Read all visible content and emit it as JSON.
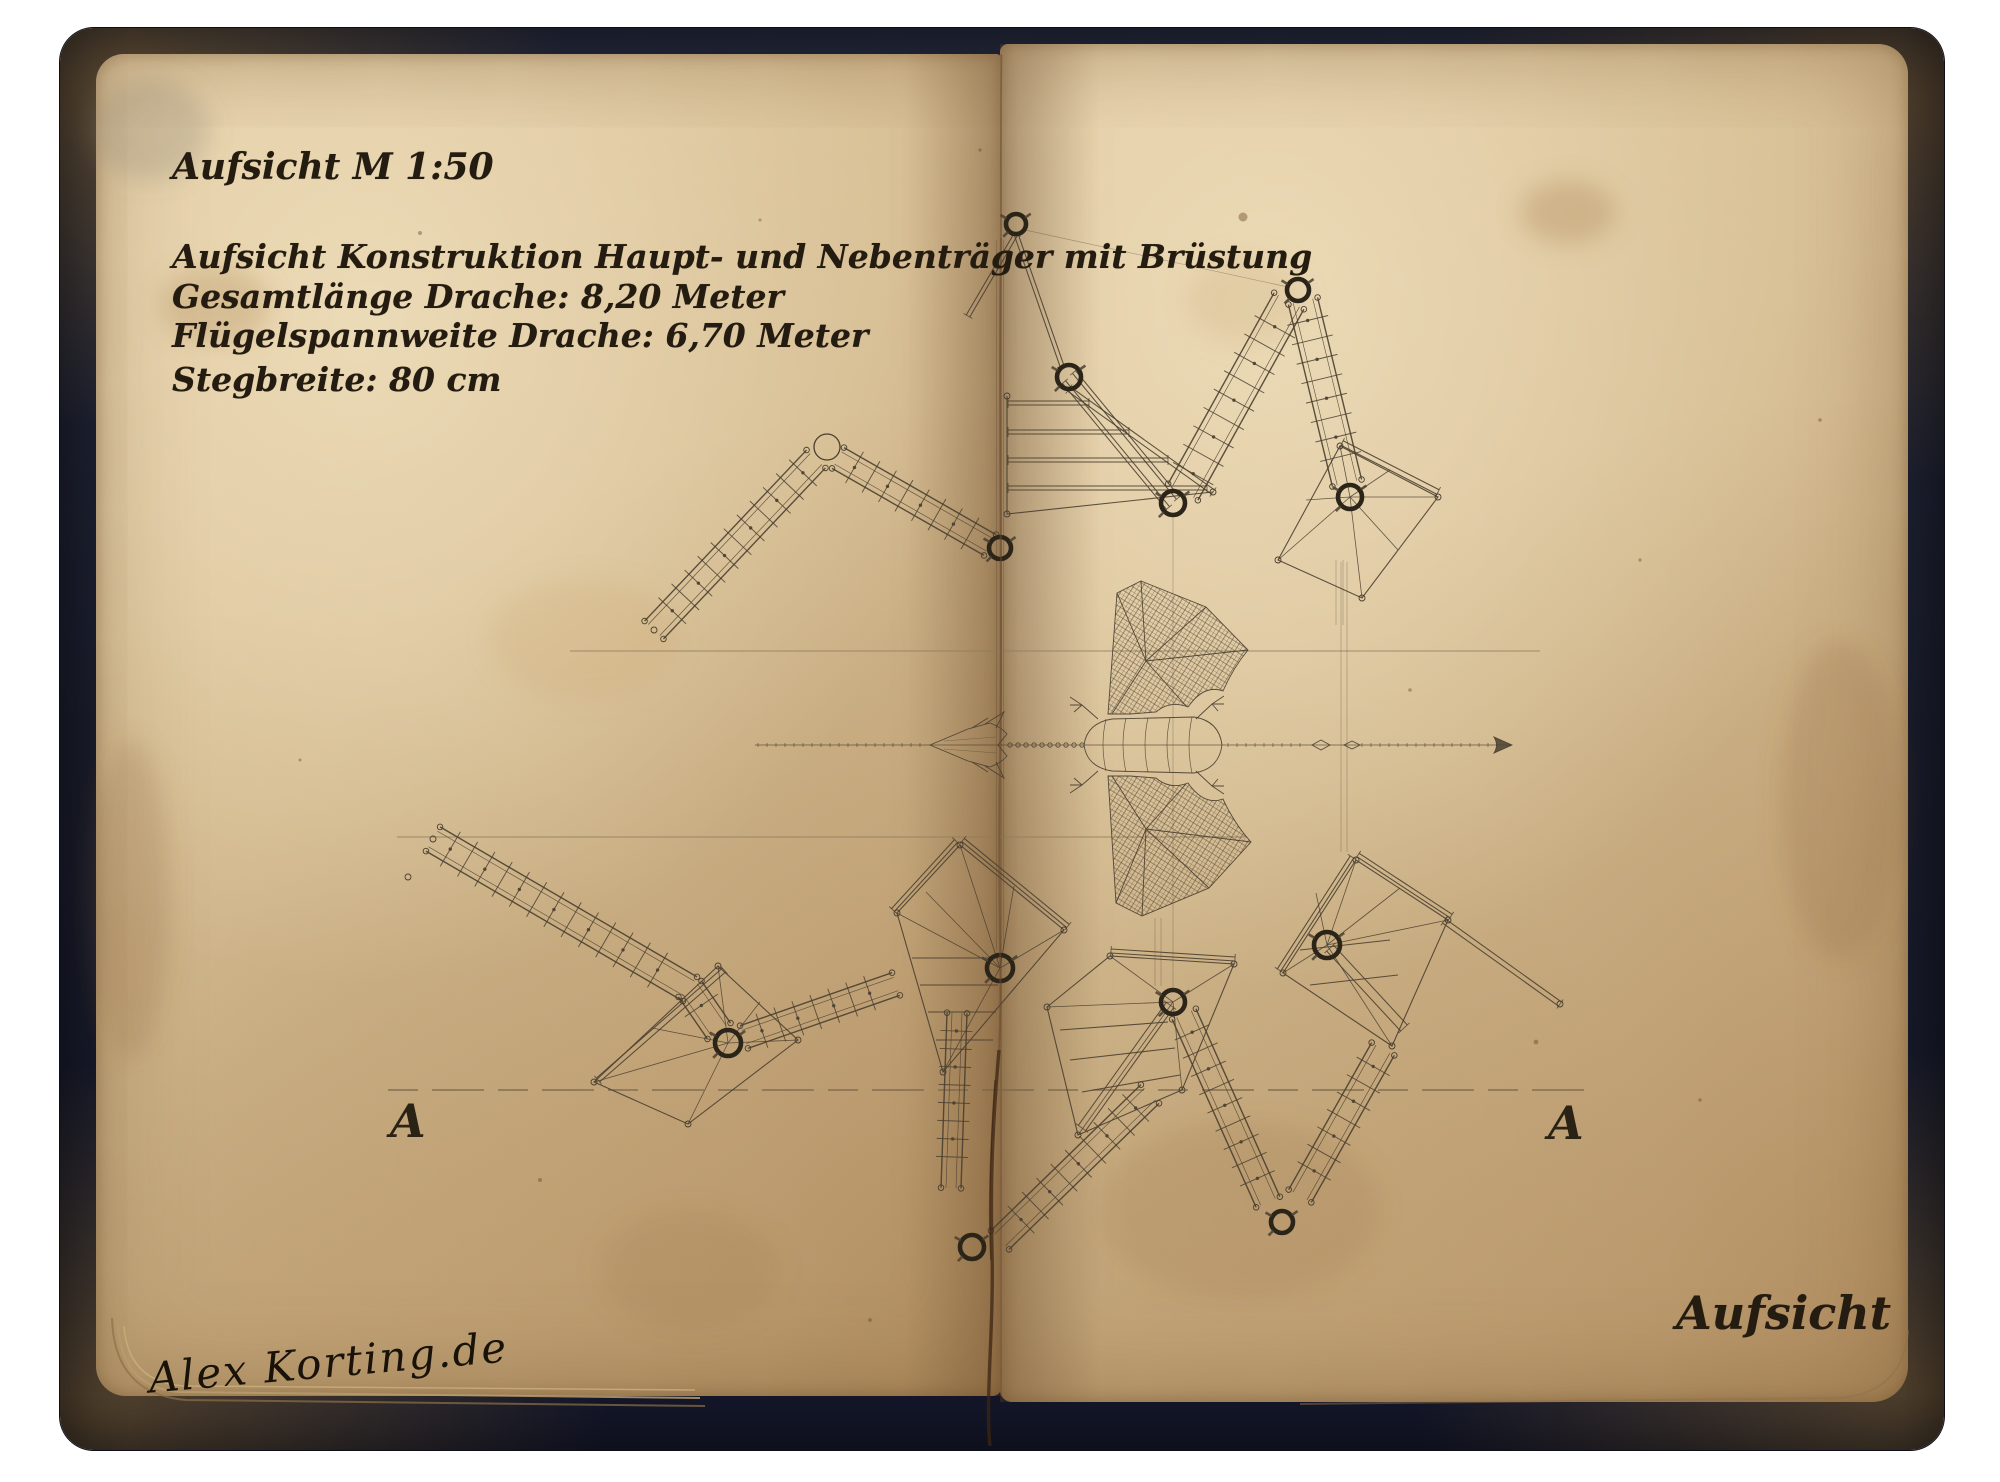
{
  "header": {
    "scale_label": "Aufsicht M 1:50"
  },
  "notes": [
    "Aufsicht Konstruktion Haupt- und Nebenträger mit Brüstung",
    "Gesamtlänge Drache: 8,20 Meter",
    "Flügelspannweite Drache: 6,70 Meter",
    "Stegbreite: 80 cm"
  ],
  "section_markers": {
    "left": "A",
    "right": "A"
  },
  "footer": {
    "view_label": "Aufsicht",
    "signature": "Alex Korting.de"
  },
  "colors": {
    "paper": "#d7bf96",
    "paper_light": "#e9d7b2",
    "paper_dark": "#c2a176",
    "cover": "#1e2233",
    "ink": "#4a3f30",
    "ink_bold": "#2b2418",
    "guide_line": "#8d7c5f",
    "crease": "#5f4527"
  }
}
